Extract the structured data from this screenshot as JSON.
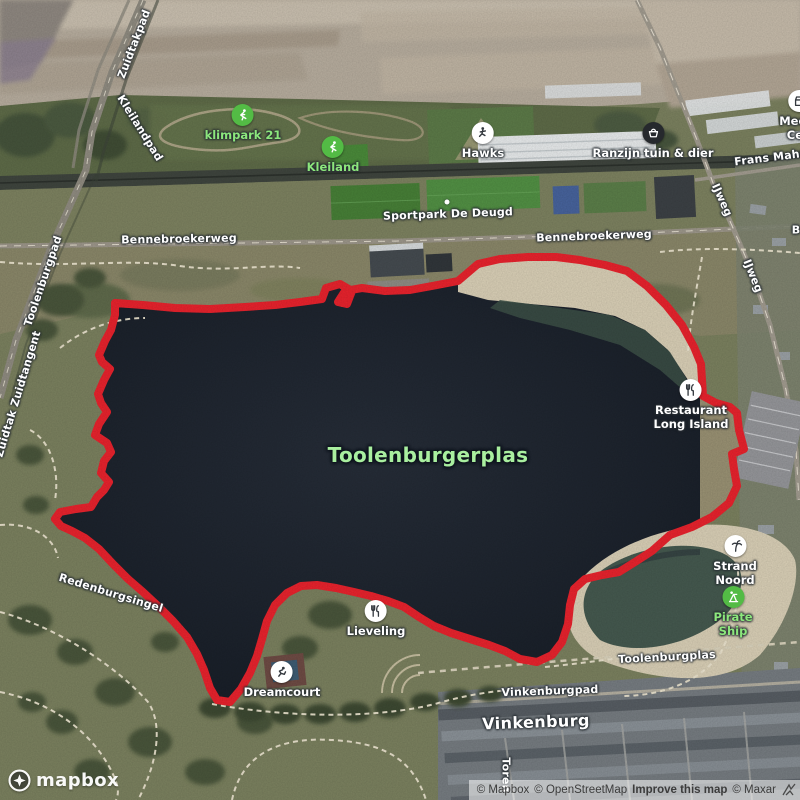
{
  "map": {
    "colors": {
      "route": "#e8232d",
      "water": "#1d232c",
      "sand": "#d9cfb6",
      "poi_green_bg": "#53bb45",
      "poi_green_text": "#8ce77c",
      "lake_label_color": "#a9ef9f"
    },
    "lake_label": {
      "text": "Toolenburgerplas",
      "x": 428,
      "y": 455,
      "size": 20,
      "color": "#a9ef9f"
    },
    "area_labels": [
      {
        "text": "Vinkenburg",
        "x": 536,
        "y": 722,
        "rot": -2
      }
    ],
    "road_labels": [
      {
        "text": "Zuidtakpad",
        "x": 134,
        "y": 44,
        "rot": -69
      },
      {
        "text": "Kleilandpad",
        "x": 140,
        "y": 128,
        "rot": 58
      },
      {
        "text": "Toolenburgpad",
        "x": 43,
        "y": 281,
        "rot": -71
      },
      {
        "text": "Zuidtak Zuidtangent",
        "x": 18,
        "y": 394,
        "rot": -73
      },
      {
        "text": "Bennebroekerweg",
        "x": 179,
        "y": 239,
        "rot": -1
      },
      {
        "text": "Bennebroekerweg",
        "x": 594,
        "y": 236,
        "rot": -2
      },
      {
        "text": "Sportpark De Deugd",
        "x": 448,
        "y": 214,
        "rot": -2,
        "dot": [
          447,
          202
        ]
      },
      {
        "text": "Frans Mahnp",
        "x": 775,
        "y": 157,
        "rot": -7
      },
      {
        "text": "IJweg",
        "x": 722,
        "y": 200,
        "rot": 66
      },
      {
        "text": "IJweg",
        "x": 753,
        "y": 276,
        "rot": 68
      },
      {
        "text": "Toolenburgplas",
        "x": 667,
        "y": 657,
        "rot": -3
      },
      {
        "text": "Vinkenburgpad",
        "x": 550,
        "y": 691,
        "rot": -2
      },
      {
        "text": "Redenburgsingel",
        "x": 111,
        "y": 593,
        "rot": 17
      },
      {
        "text": "Toren",
        "x": 506,
        "y": 775,
        "rot": 90
      },
      {
        "text": "B",
        "x": 796,
        "y": 230,
        "rot": 0
      }
    ],
    "pois": [
      {
        "label": "klimpark 21",
        "icon": "climbing-icon",
        "style": "green",
        "x": 243,
        "y": 115
      },
      {
        "label": "Kleiland",
        "icon": "climbing-icon",
        "style": "green",
        "x": 333,
        "y": 147
      },
      {
        "label": "Hawks",
        "icon": "baseball-icon",
        "style": "white",
        "x": 483,
        "y": 133
      },
      {
        "label": "Ranzijn tuin & dier",
        "icon": "shopping-basket-icon",
        "style": "dark",
        "x": 653,
        "y": 133
      },
      {
        "label": "Meers\nCen",
        "icon": "store-icon",
        "style": "white",
        "x": 799,
        "y": 101
      },
      {
        "label": "Restaurant\nLong Island",
        "icon": "restaurant-icon",
        "style": "white",
        "x": 691,
        "y": 390
      },
      {
        "label": "Strand Noord",
        "icon": "beach-icon",
        "style": "white",
        "x": 735,
        "y": 546
      },
      {
        "label": "Pirate Ship",
        "icon": "playground-icon",
        "style": "green",
        "x": 733,
        "y": 597
      },
      {
        "label": "Lieveling",
        "icon": "restaurant-icon",
        "style": "white",
        "x": 376,
        "y": 611
      },
      {
        "label": "Dreamcourt",
        "icon": "sports-icon",
        "style": "white",
        "x": 282,
        "y": 672
      }
    ],
    "route": {
      "color": "#e8232d",
      "width": 8,
      "points": [
        [
          115,
          303
        ],
        [
          143,
          305
        ],
        [
          175,
          308
        ],
        [
          210,
          309
        ],
        [
          245,
          307
        ],
        [
          275,
          305
        ],
        [
          300,
          302
        ],
        [
          322,
          299
        ],
        [
          326,
          288
        ],
        [
          340,
          284
        ],
        [
          352,
          291
        ],
        [
          347,
          304
        ],
        [
          338,
          302
        ],
        [
          345,
          291
        ],
        [
          362,
          288
        ],
        [
          385,
          291
        ],
        [
          410,
          290
        ],
        [
          432,
          286
        ],
        [
          458,
          281
        ],
        [
          478,
          264
        ],
        [
          500,
          259
        ],
        [
          528,
          257
        ],
        [
          556,
          257
        ],
        [
          580,
          260
        ],
        [
          605,
          265
        ],
        [
          627,
          271
        ],
        [
          647,
          286
        ],
        [
          666,
          305
        ],
        [
          682,
          325
        ],
        [
          694,
          347
        ],
        [
          701,
          364
        ],
        [
          702,
          380
        ],
        [
          703,
          396
        ],
        [
          716,
          403
        ],
        [
          730,
          407
        ],
        [
          737,
          413
        ],
        [
          739,
          430
        ],
        [
          744,
          449
        ],
        [
          732,
          454
        ],
        [
          734,
          469
        ],
        [
          737,
          486
        ],
        [
          729,
          503
        ],
        [
          712,
          517
        ],
        [
          692,
          527
        ],
        [
          670,
          535
        ],
        [
          652,
          551
        ],
        [
          635,
          562
        ],
        [
          619,
          572
        ],
        [
          602,
          575
        ],
        [
          585,
          579
        ],
        [
          574,
          589
        ],
        [
          570,
          605
        ],
        [
          568,
          624
        ],
        [
          562,
          642
        ],
        [
          552,
          655
        ],
        [
          537,
          662
        ],
        [
          520,
          659
        ],
        [
          505,
          651
        ],
        [
          489,
          645
        ],
        [
          470,
          639
        ],
        [
          451,
          633
        ],
        [
          434,
          626
        ],
        [
          419,
          617
        ],
        [
          404,
          607
        ],
        [
          388,
          601
        ],
        [
          371,
          596
        ],
        [
          354,
          592
        ],
        [
          336,
          588
        ],
        [
          317,
          585
        ],
        [
          301,
          586
        ],
        [
          287,
          593
        ],
        [
          275,
          605
        ],
        [
          267,
          621
        ],
        [
          262,
          639
        ],
        [
          257,
          656
        ],
        [
          250,
          673
        ],
        [
          241,
          689
        ],
        [
          230,
          702
        ],
        [
          217,
          700
        ],
        [
          210,
          688
        ],
        [
          204,
          670
        ],
        [
          197,
          654
        ],
        [
          187,
          637
        ],
        [
          173,
          621
        ],
        [
          158,
          606
        ],
        [
          143,
          592
        ],
        [
          128,
          579
        ],
        [
          113,
          564
        ],
        [
          99,
          549
        ],
        [
          85,
          538
        ],
        [
          72,
          531
        ],
        [
          61,
          526
        ],
        [
          55,
          519
        ],
        [
          60,
          512
        ],
        [
          76,
          509
        ],
        [
          91,
          507
        ],
        [
          97,
          497
        ],
        [
          104,
          490
        ],
        [
          109,
          482
        ],
        [
          101,
          473
        ],
        [
          104,
          461
        ],
        [
          111,
          452
        ],
        [
          107,
          443
        ],
        [
          95,
          435
        ],
        [
          99,
          424
        ],
        [
          107,
          412
        ],
        [
          101,
          403
        ],
        [
          98,
          394
        ],
        [
          104,
          380
        ],
        [
          110,
          369
        ],
        [
          102,
          362
        ],
        [
          99,
          355
        ],
        [
          105,
          341
        ],
        [
          111,
          330
        ],
        [
          115,
          315
        ],
        [
          115,
          303
        ]
      ]
    }
  },
  "branding": {
    "logo_text": "mapbox"
  },
  "attribution": {
    "mapbox": "© Mapbox",
    "osm": "© OpenStreetMap",
    "improve": "Improve this map",
    "maxar": "© Maxar"
  }
}
